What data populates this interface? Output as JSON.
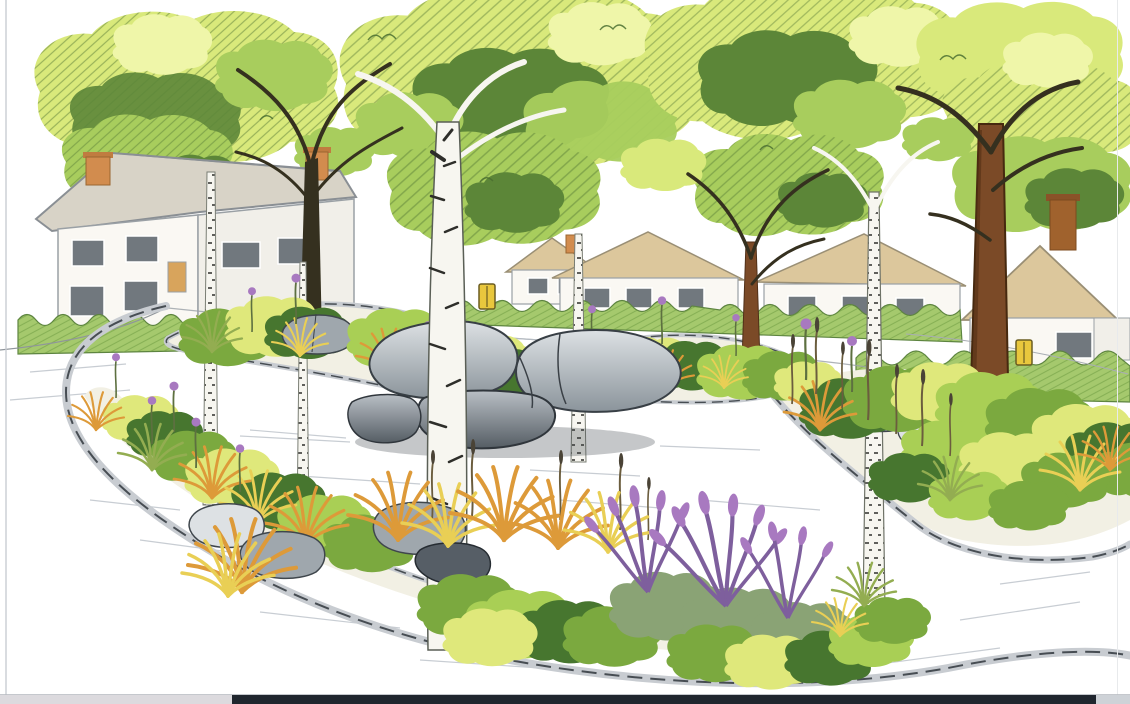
{
  "meta": {
    "kind": "hand-drawn-illustration",
    "medium": "ink and colored pencil sketch",
    "subject": "Landscaped residential street corner: kerbed island planting beds with birch and broadleaf trees, ornamental grasses, allium and lavender flowers, a central boulder cluster, and suburban houses with hedges behind"
  },
  "scene": {
    "objects": [
      "background-tree-canopies",
      "two-storey-house",
      "bungalow-row",
      "right-gable-house",
      "chimneys",
      "hedges",
      "road-surface",
      "kerb-stones",
      "island-planting-beds",
      "foreground-planting-bed",
      "central-boulder-cluster",
      "small-rock-groups",
      "birch-trunks",
      "brown-tree-trunks",
      "ornamental-grass-tufts",
      "allium-flowers",
      "lavender-bushes",
      "seed-head-stems",
      "yellow-grit-bins",
      "page-edge",
      "bottom-window-bar"
    ]
  },
  "palette": {
    "paper": "#ffffff",
    "canopy_light": "#d9e97b",
    "canopy_mid": "#a8cd5d",
    "canopy_dark": "#5c8638",
    "canopy_glow": "#eff6a9",
    "canopy_hatch": "#4a6e30",
    "shrub_dark": "#47762f",
    "shrub_mid": "#7ba93f",
    "shrub_light": "#a9cf55",
    "shrub_yellow": "#dfe87b",
    "lavender_leaf": "#8aa375",
    "grass_orange": "#dd9a39",
    "grass_yellow": "#e9cf55",
    "grass_green": "#93ad51",
    "stem_green": "#5d7040",
    "reed_stem": "#6b5d3e",
    "flower_purple": "#a879c0",
    "flower_purple_dark": "#7e5f9d",
    "rock_light": "#dde1e4",
    "rock_mid": "#9fa7ad",
    "rock_dark": "#565e66",
    "kerb_light": "#c8ccd1",
    "kerb_dark": "#474d53",
    "road_hatch": "#b6bcc4",
    "bed_soil": "#f2f0e4",
    "wall": "#faf8f3",
    "roof_tan": "#dcc79c",
    "roof_gray": "#d8d3c7",
    "window_dark": "#71787e",
    "chimney_orange": "#d28c4e",
    "hedge_green": "#a5c96d",
    "hedge_dark": "#6e9c42",
    "trunk_brown": "#7b4a27",
    "branch_dark": "#35301f",
    "birch_white": "#f7f6f0",
    "birch_mark": "#2e2e2a",
    "bin_yellow": "#e9c73d",
    "page_edge": "#c9cdd2",
    "bar_light": "#dcdade",
    "bar_dark": "#20262e",
    "bar_right": "#ced2d7"
  },
  "window": {
    "bottom_bar": {
      "segments": [
        {
          "name": "left-light",
          "color_key": "bar_light"
        },
        {
          "name": "center-dark",
          "color_key": "bar_dark"
        },
        {
          "name": "right-light",
          "color_key": "bar_right"
        }
      ]
    }
  }
}
